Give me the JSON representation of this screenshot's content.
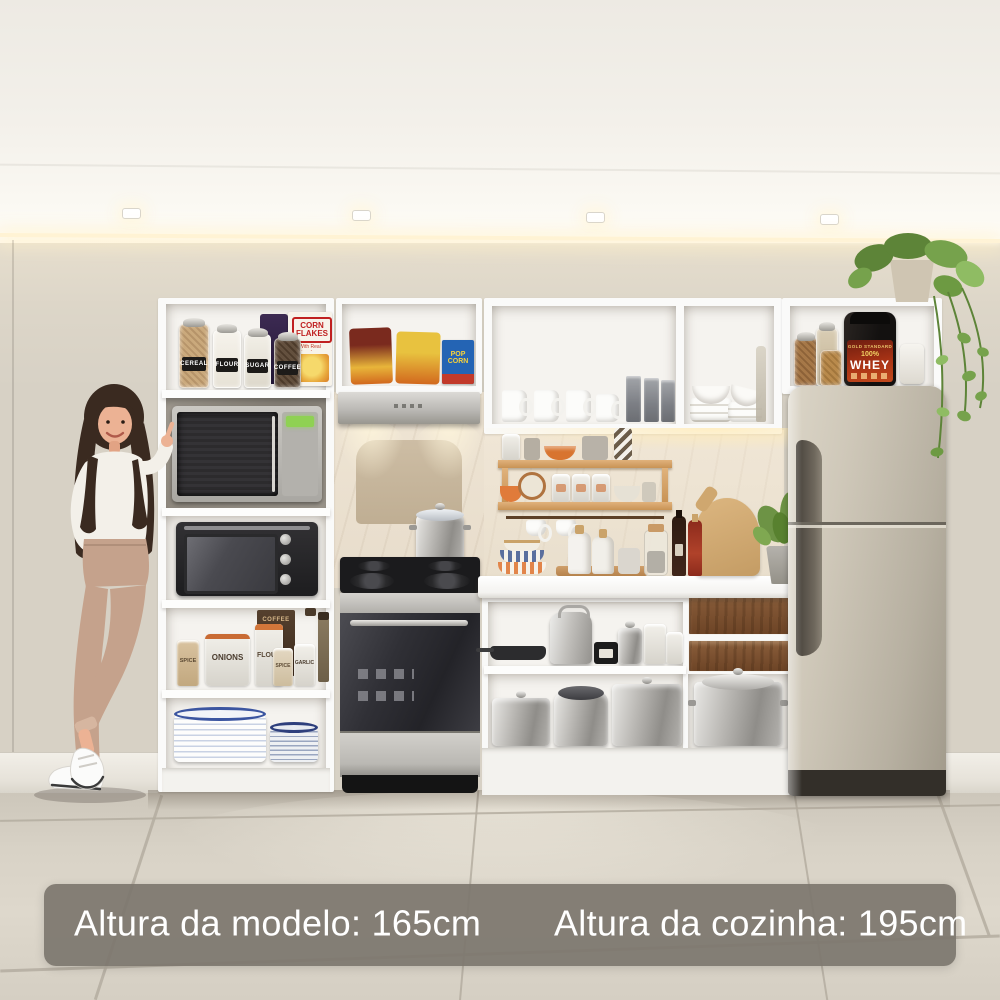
{
  "banner": {
    "model_height": "Altura da modelo: 165cm",
    "kitchen_height": "Altura da cozinha: 195cm"
  },
  "labels": {
    "top_jars": [
      "CEREAL",
      "FLOUR",
      "SUGAR",
      "COFFEE"
    ],
    "cereal_box_title": "CORN FLAKES",
    "cereal_box_sub": "With Real Strawberry",
    "popcorn_box": "POP CORN",
    "spice": "SPICE",
    "onions": "ONIONS",
    "flour": "FLOUR",
    "coffee": "COFFEE",
    "garlic": "GARLIC",
    "whey_brand": "GOLD STANDARD",
    "whey_pct": "100%",
    "whey_title": "WHEY"
  },
  "colors": {
    "wall_left": "#7c7468",
    "wall_center": "#b09882",
    "wall_right": "#847b6f",
    "ceiling": "#f3f0ea",
    "floor": "#d8d2c6",
    "cabinet_white": "#fafaf9",
    "wood_shelf": "#d9a873",
    "drawer_wood": "#7d5638",
    "fridge_inox": "#c9c2b2",
    "stove_dark": "#2e2e33",
    "banner_bg": "#7c766e",
    "plant_green": "#6d9345",
    "accent_orange": "#d8742f"
  }
}
